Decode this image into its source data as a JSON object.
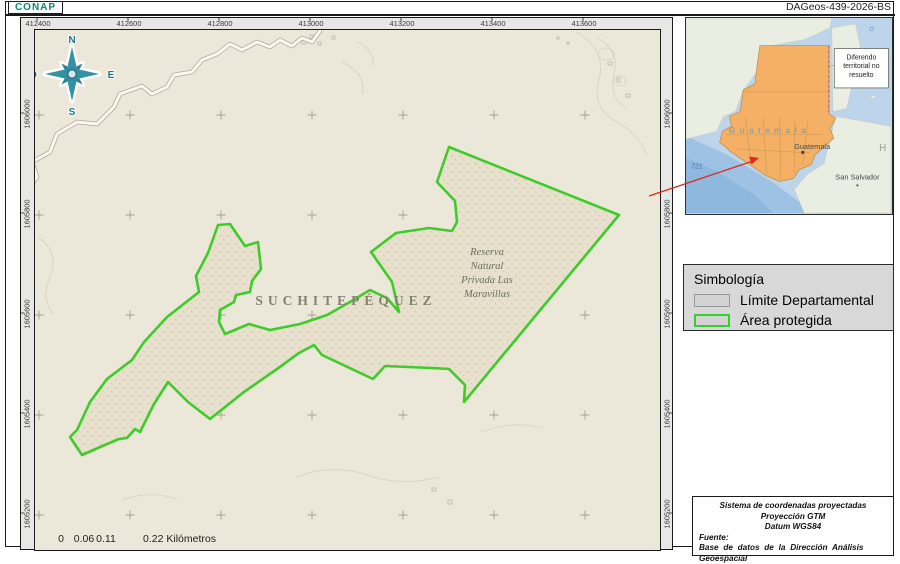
{
  "header": {
    "logo": "CONAP",
    "code": "DAGeos-439-2026-BS"
  },
  "map": {
    "top_labels": [
      "412400",
      "412600",
      "412800",
      "413000",
      "413200",
      "413400",
      "413600"
    ],
    "side_labels": [
      "1606000",
      "1605800",
      "1605600",
      "1605400",
      "1605200"
    ],
    "department": "SUCHITEPÉQUEZ",
    "reserve_lines": [
      "Reserva",
      "Natural",
      "Privada Las",
      "Maravillas"
    ],
    "compass": {
      "n": "N",
      "e": "E",
      "s": "S",
      "o": "O"
    },
    "scale": {
      "t0": "0",
      "t1": "0.06",
      "t2": "0.11",
      "end": "0.22 Kilómetros"
    }
  },
  "inset": {
    "country": "G u a t e m a l a",
    "capital": "Guatemala",
    "neighbor_city": "San Salvador",
    "honduras": "H o",
    "road": "721",
    "note": [
      "Diferendo",
      "territorial no",
      "resuelto"
    ]
  },
  "legend": {
    "title": "Simbología",
    "items": [
      {
        "label": "Límite Departamental"
      },
      {
        "label": "Área protegida"
      }
    ]
  },
  "info": {
    "line1": "Sistema de coordenadas proyectadas",
    "line2": "Proyección GTM",
    "line3": "Datum WGS84",
    "fuente": "Fuente:",
    "source": "Base de datos de la Dirección Análisis Geoespacial"
  },
  "colors": {
    "protected_green": "#3ecc28",
    "guatemala_orange": "#f4b065",
    "logo_teal": "#0c8a6e"
  }
}
